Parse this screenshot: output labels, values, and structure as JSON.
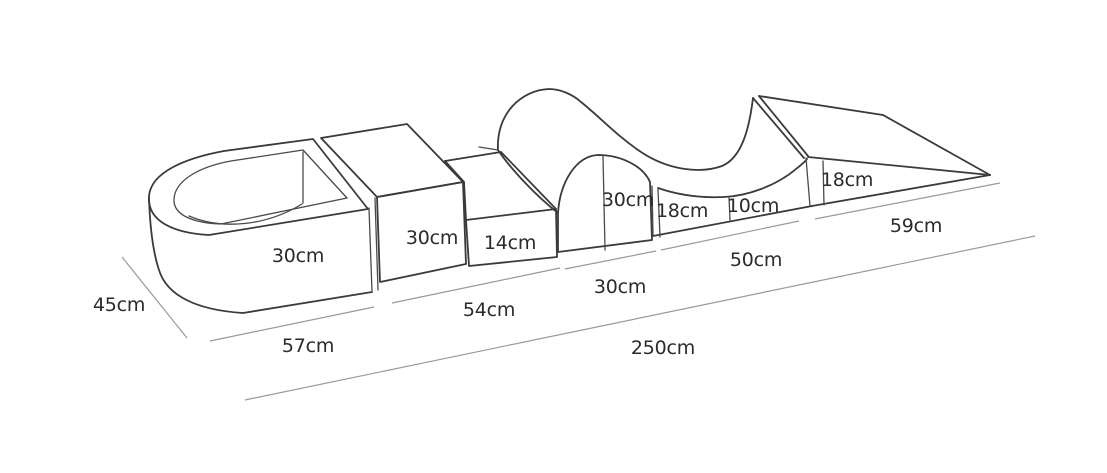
{
  "diagram": {
    "type": "soft-play-foam-set-dimension-drawing",
    "background_color": "#ffffff",
    "line_color": "#3a3a3a",
    "dimension_line_color": "#9a9a9a",
    "text_color": "#2b2b2b",
    "piece_labels": {
      "ballpit_height": "30cm",
      "cube_height": "30cm",
      "step_height": "14cm",
      "arch_height": "30cm",
      "wave_left_height": "18cm",
      "wave_trough_height": "10cm",
      "ramp_height": "18cm"
    },
    "dimension_labels": {
      "depth": "45cm",
      "ballpit_length": "57cm",
      "cube_step_length": "54cm",
      "arch_length": "30cm",
      "wave_length": "50cm",
      "ramp_length": "59cm",
      "total_length": "250cm"
    }
  }
}
